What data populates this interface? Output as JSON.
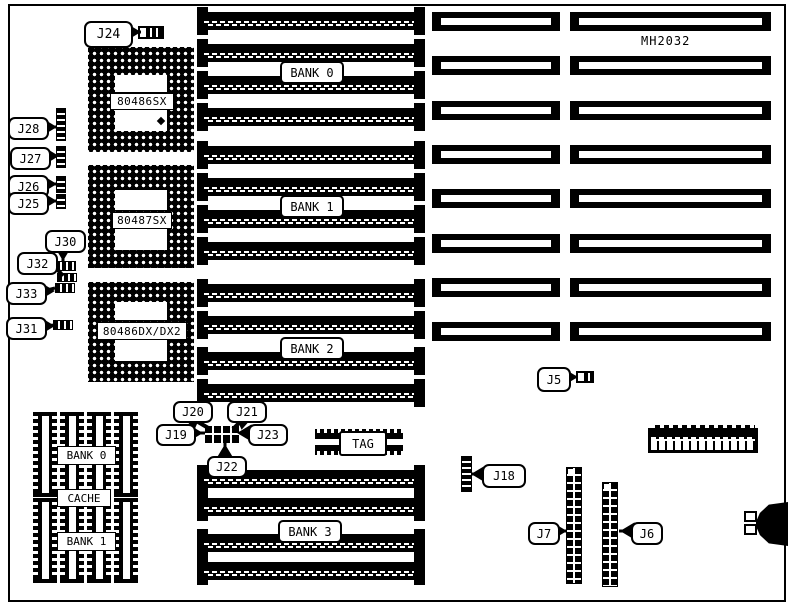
{
  "diagram": {
    "part_number": "MH2032",
    "cpu_sockets": {
      "sx": "80486SX",
      "fpu": "80487SX",
      "dx": "80486DX/DX2"
    },
    "simm_banks": {
      "bank0": "BANK 0",
      "bank1": "BANK 1",
      "bank2": "BANK 2",
      "bank3": "BANK 3"
    },
    "cache_area": {
      "bank0": "BANK 0",
      "cache": "CACHE",
      "bank1": "BANK 1"
    },
    "tag": "TAG",
    "callouts": {
      "j5": "J5",
      "j6": "J6",
      "j7": "J7",
      "j18": "J18",
      "j19": "J19",
      "j20": "J20",
      "j21": "J21",
      "j22": "J22",
      "j23": "J23",
      "j24": "J24",
      "j25": "J25",
      "j26": "J26",
      "j27": "J27",
      "j28": "J28",
      "j30": "J30",
      "j31": "J31",
      "j32": "J32",
      "j33": "J33"
    },
    "counts": {
      "simm_slots_per_bank": 4,
      "simm_banks": 4,
      "expansion_slot_rows": 8,
      "cache_chips": 8,
      "cpu_sockets": 3
    },
    "colors": {
      "ink": "#000000",
      "background": "#ffffff"
    }
  }
}
